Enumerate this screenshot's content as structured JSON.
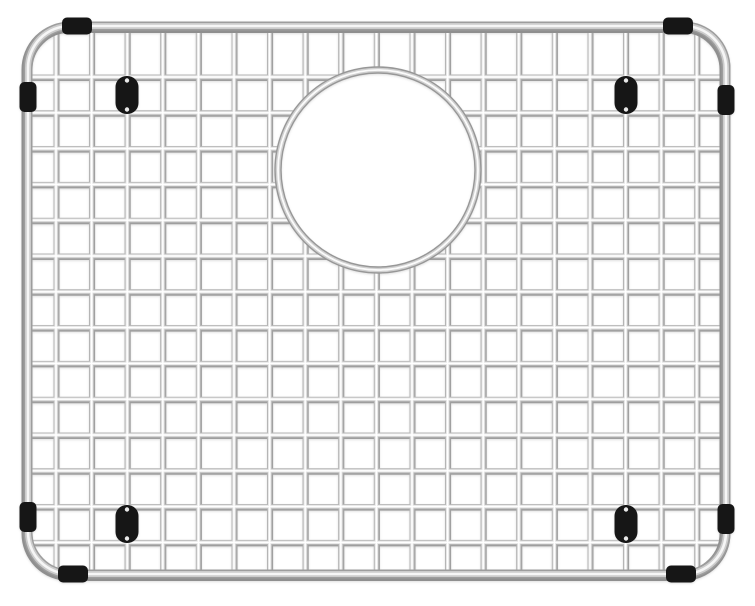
{
  "page": {
    "background_color": "#ffffff",
    "object_name": "stainless steel sink bottom grid with circular drain opening, black rubber bumpers and feet"
  },
  "figure": {
    "kind": "product-photo",
    "canvas": {
      "width": 755,
      "height": 606
    },
    "colors": {
      "background": "#ffffff",
      "rubber": "#161616",
      "rubber_dot": "#e9e9e9"
    },
    "frame": {
      "x": 28,
      "y": 26,
      "width": 698,
      "height": 548,
      "corner_radius": 42
    },
    "wires": {
      "vertical": {
        "start_x": 56,
        "spacing": 35.6,
        "count": 19,
        "y1": 28,
        "y2": 573
      },
      "horizontal": {
        "start_y": 77,
        "spacing": 35.8,
        "count": 14,
        "x1": 27,
        "x2": 726
      }
    },
    "ring": {
      "cx": 378,
      "cy": 170,
      "radius": 100,
      "mask_radius": 97
    },
    "render": {
      "wire_layers": [
        {
          "color": "#9e9e9e",
          "width": 6.0,
          "dx": 0.5,
          "dy": 1.0
        },
        {
          "color": "#b6b6b6",
          "width": 5.0,
          "dx": 0,
          "dy": 0
        },
        {
          "color": "#e6e6e6",
          "width": 3.2,
          "dx": 0,
          "dy": 0
        },
        {
          "color": "#ffffff",
          "width": 1.4,
          "dx": 0,
          "dy": 0
        }
      ],
      "frame_layers": [
        {
          "color": "#8f8f8f",
          "width": 11.0,
          "dx": -1.0,
          "dy": 1.5
        },
        {
          "color": "#9d9d9d",
          "width": 9.0,
          "dx": 0,
          "dy": 0
        },
        {
          "color": "#cccccc",
          "width": 6.0,
          "dx": 0,
          "dy": 0
        },
        {
          "color": "#f6f6f6",
          "width": 2.6,
          "dx": 0,
          "dy": 0
        }
      ],
      "ring_layers": [
        {
          "color": "#979797",
          "width": 7.4,
          "dx": 0,
          "dy": 0
        },
        {
          "color": "#d0d0d0",
          "width": 4.6,
          "dx": 0,
          "dy": 0
        },
        {
          "color": "#fbfbfb",
          "width": 1.8,
          "dx": 0,
          "dy": 0
        }
      ]
    },
    "bumper_size": {
      "long": 30,
      "short": 17,
      "corner_radius": 5
    },
    "bumpers": [
      {
        "edge": "top",
        "cx": 77,
        "cy": 26
      },
      {
        "edge": "left",
        "cx": 28,
        "cy": 97
      },
      {
        "edge": "top",
        "cx": 678,
        "cy": 26
      },
      {
        "edge": "right",
        "cx": 726,
        "cy": 100
      },
      {
        "edge": "left",
        "cx": 28,
        "cy": 517
      },
      {
        "edge": "bottom",
        "cx": 73,
        "cy": 574
      },
      {
        "edge": "right",
        "cx": 726,
        "cy": 519
      },
      {
        "edge": "bottom",
        "cx": 681,
        "cy": 574
      }
    ],
    "foot": {
      "width": 23,
      "height": 38,
      "corner_radius": 11,
      "dot_radius": 2.2,
      "dot_inset": 4.5
    },
    "feet": [
      {
        "cx": 127,
        "cy": 95
      },
      {
        "cx": 626,
        "cy": 95
      },
      {
        "cx": 127,
        "cy": 524
      },
      {
        "cx": 626,
        "cy": 524
      }
    ]
  }
}
